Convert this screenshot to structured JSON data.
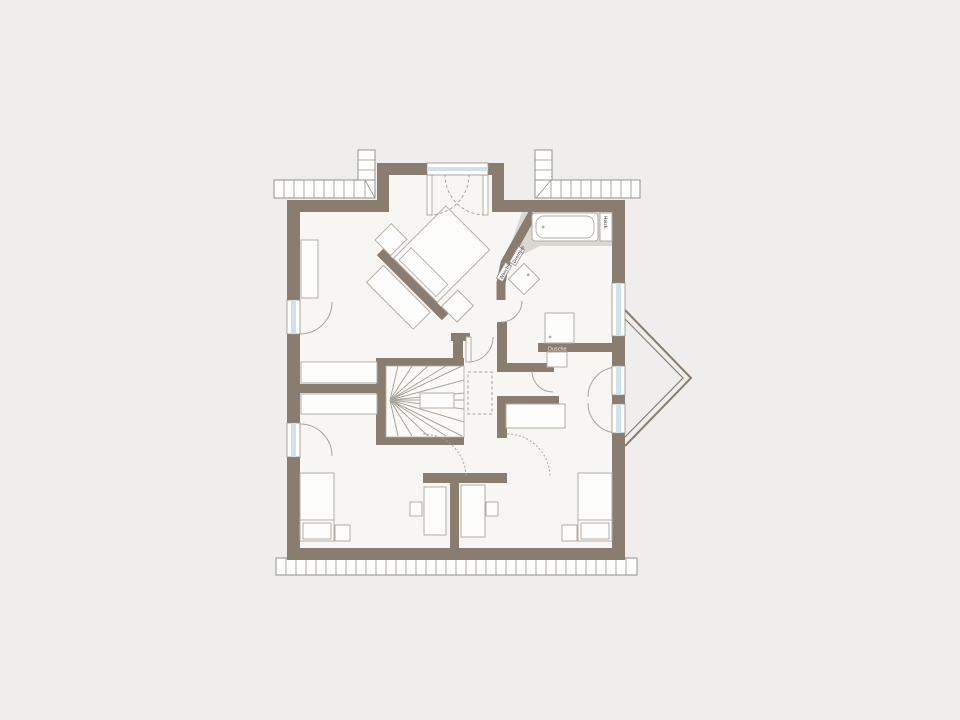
{
  "title": "Obergeschoss Grundriss (upper floor plan)",
  "colors": {
    "background": "#efeeec",
    "wall": "#897d70",
    "floor": "#f7f6f3",
    "tile": "#dbd7d1",
    "glazing": "#cfe2ec",
    "line": "#aaa49c",
    "hatchline": "#97918a",
    "furniture": "#fdfdfb",
    "furnstroke": "#b3ada4",
    "label": "#3a352f"
  },
  "labels": {
    "radiator": "Heizk.",
    "wall_strip_1": "Drempel",
    "wall_strip_2": "Waschb.",
    "shower_wall": "Dusche"
  }
}
